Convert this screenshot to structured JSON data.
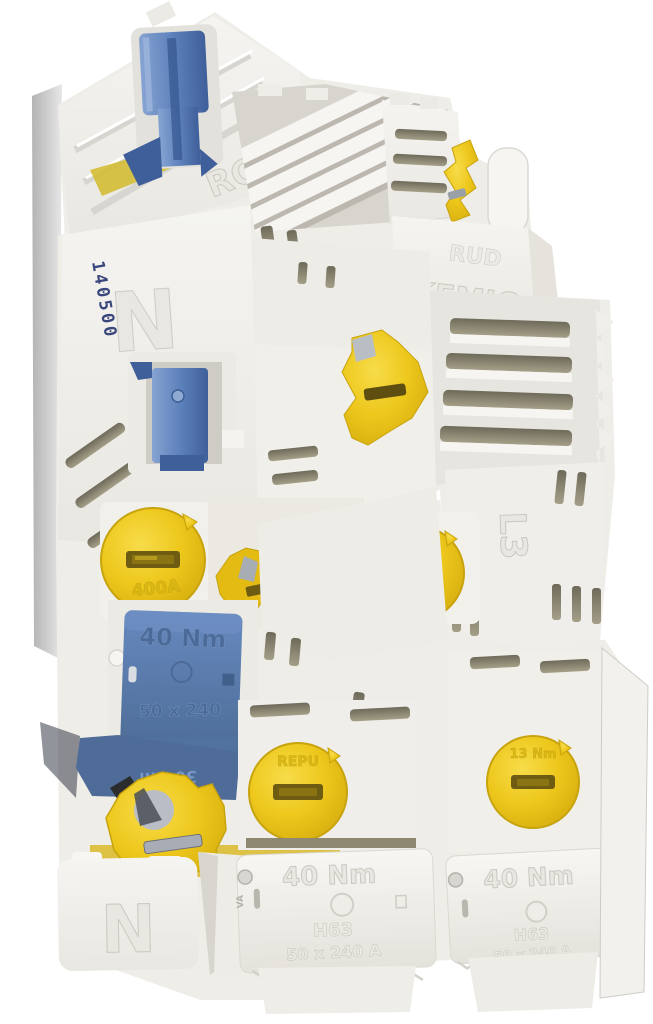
{
  "photo": {
    "background_color": "#ffffff",
    "colors": {
      "plastic_white": "#f3f2ee",
      "plastic_shade": "#d8d5cf",
      "handle_blue": "#5d81bb",
      "cover_blue": "#54749f",
      "cap_yellow": "#edc71b",
      "slot_dark": "#8e8a79",
      "stamp_ink": "#39477c",
      "shadow_gray": "#a6a6a6"
    },
    "markings": {
      "stamped_serial": "140500",
      "neutral_left": "N",
      "neutral_bottom": "N",
      "housing_code": "RCB",
      "brand_line1": "RUD",
      "brand_line2": "KEMIC",
      "phase_label": "L3",
      "torque_40": "40 Nm",
      "torque_30": "30 Nm",
      "torque_13": "13 Nm",
      "cross_section": "50 x 240",
      "cross_section_amp": "50 x 240 A",
      "size_code": "H63",
      "cap_text": "REPU",
      "amp_rating": "400A",
      "conductor_code": "CU/AL",
      "va_code": "VA"
    }
  }
}
